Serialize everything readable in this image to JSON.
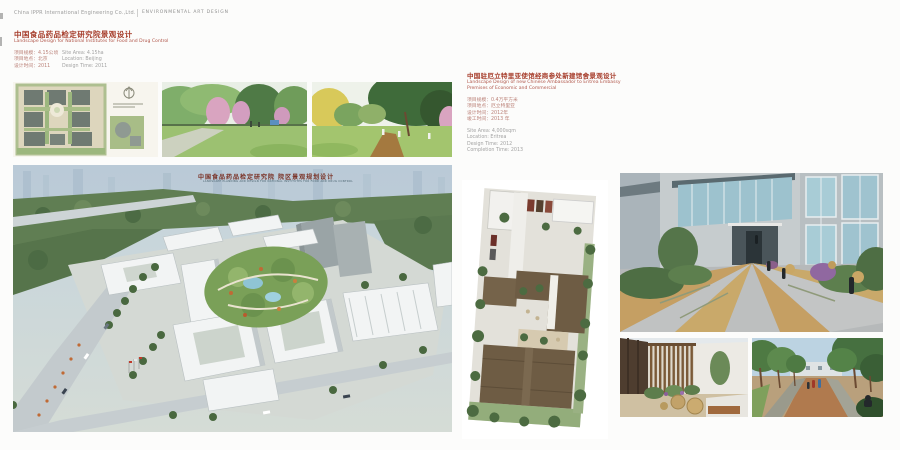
{
  "header": {
    "company": "China IPPR International Engineering Co.,Ltd.",
    "divider": "|",
    "section": "ENVIRONMENTAL ART DESIGN"
  },
  "left_project": {
    "title_zh": "中国食品药品检定研究院景观设计",
    "title_en": "Landscape Design for National Institutes for Food and Drug Control",
    "details": {
      "zh": [
        "项目规模：4.15公顷",
        "项目地点：北京",
        "设计时间：2011"
      ],
      "en": [
        "Site Area: 4.15ha",
        "Location: Beijing",
        "Design Time: 2011"
      ]
    },
    "aerial_caption_zh": "中国食品药品检定研究院 院区景观规划设计",
    "aerial_caption_en": "LANDSCAPE PLANNING AND DESIGN FOR NATIONAL INSTITUTES FOR FOOD AND DRUG CONTROL"
  },
  "right_project": {
    "title_zh": "中国驻厄立特里亚使馆经商参处新建馆舍景观设计",
    "title_en_line1": "Landscape Design of new Chinese Ambassador to Eritrea Embassy",
    "title_en_line2": "Premises of Economic and Commercial",
    "details": {
      "zh": [
        "项目规模：0.4万平方米",
        "项目地点：厄立特里亚",
        "设计时间：2012年",
        "竣工时间：2013 年"
      ],
      "en": [
        "Site Area: 4,000sqm",
        "Location: Eritrea",
        "Design Time: 2012",
        "Completion Time: 2013"
      ]
    }
  },
  "colors": {
    "title_red": "#a63c2a",
    "detail_red": "#bb8279",
    "detail_gray": "#a3a3a3",
    "header_gray": "#9b9b9b"
  }
}
